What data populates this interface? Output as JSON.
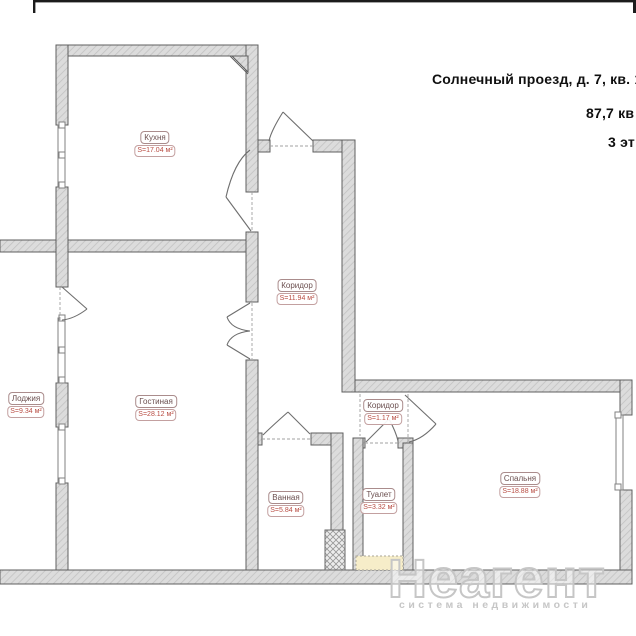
{
  "title": {
    "line1": "Солнечный проезд, д. 7, кв. 1",
    "line2": "87,7 кв",
    "line3": "3 эт"
  },
  "rooms": [
    {
      "name": "Кухня",
      "area": "S=17.04 м²"
    },
    {
      "name": "Коридор",
      "area": "S=11.94 м²"
    },
    {
      "name": "Лоджия",
      "area": "S=9.34 м²"
    },
    {
      "name": "Гостиная",
      "area": "S=28.12 м²"
    },
    {
      "name": "Ванная",
      "area": "S=5.84 м²"
    },
    {
      "name": "Туалет",
      "area": "S=3.32 м²"
    },
    {
      "name": "Коридор",
      "area": "S=1.17 м²"
    },
    {
      "name": "Спальня",
      "area": "S=18.88 м²"
    }
  ],
  "watermark": {
    "brand": "Неагент",
    "tagline": "система недвижимости"
  },
  "colors": {
    "room_name_text": "#6b4f4f",
    "room_area_text": "#b84c42",
    "wall_outline": "#5f5f5f",
    "watermark_gray": "#c6c6c6",
    "shaft_yellow": "#f6edc9"
  }
}
